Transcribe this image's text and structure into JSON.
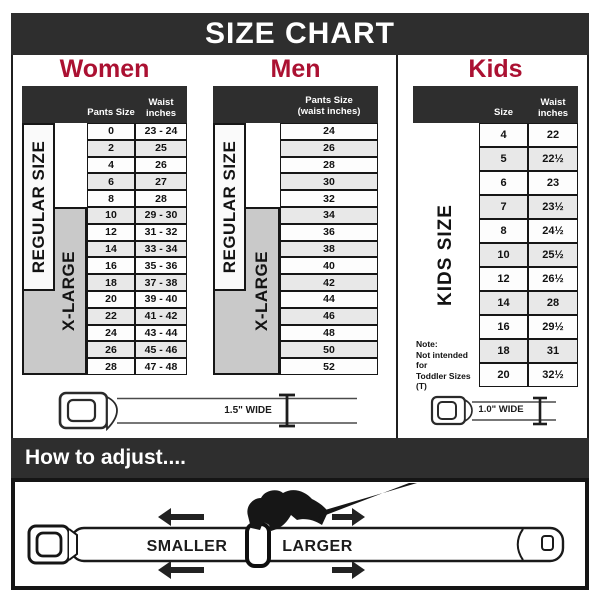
{
  "title": "SIZE CHART",
  "colors": {
    "header_bar": "#2e2e2e",
    "heading_red": "#ab1132",
    "row_stripe": "#e8e8e8",
    "label_gray": "#c9c9c9"
  },
  "sections": {
    "women": {
      "heading": "Women",
      "columns": {
        "size": "Pants Size",
        "waist_l1": "Waist",
        "waist_l2": "inches"
      },
      "labels": {
        "regular": "REGULAR SIZE",
        "xlarge": "X-LARGE"
      },
      "rows": [
        {
          "size": "0",
          "waist": "23 - 24"
        },
        {
          "size": "2",
          "waist": "25"
        },
        {
          "size": "4",
          "waist": "26"
        },
        {
          "size": "6",
          "waist": "27"
        },
        {
          "size": "8",
          "waist": "28"
        },
        {
          "size": "10",
          "waist": "29 - 30"
        },
        {
          "size": "12",
          "waist": "31 - 32"
        },
        {
          "size": "14",
          "waist": "33 - 34"
        },
        {
          "size": "16",
          "waist": "35 - 36"
        },
        {
          "size": "18",
          "waist": "37 - 38"
        },
        {
          "size": "20",
          "waist": "39 - 40"
        },
        {
          "size": "22",
          "waist": "41 - 42"
        },
        {
          "size": "24",
          "waist": "43 - 44"
        },
        {
          "size": "26",
          "waist": "45 - 46"
        },
        {
          "size": "28",
          "waist": "47 - 48"
        }
      ]
    },
    "men": {
      "heading": "Men",
      "columns": {
        "l1": "Pants Size",
        "l2": "(waist inches)"
      },
      "labels": {
        "regular": "REGULAR SIZE",
        "xlarge": "X-LARGE"
      },
      "rows": [
        "24",
        "26",
        "28",
        "30",
        "32",
        "34",
        "36",
        "38",
        "40",
        "42",
        "44",
        "46",
        "48",
        "50",
        "52"
      ]
    },
    "kids": {
      "heading": "Kids",
      "columns": {
        "size": "Size",
        "waist_l1": "Waist",
        "waist_l2": "inches"
      },
      "label": "KIDS SIZE",
      "note_lines": [
        "Note:",
        "Not intended for",
        "Toddler Sizes (T)"
      ],
      "rows": [
        {
          "size": "4",
          "waist": "22"
        },
        {
          "size": "5",
          "waist": "22½"
        },
        {
          "size": "6",
          "waist": "23"
        },
        {
          "size": "7",
          "waist": "23½"
        },
        {
          "size": "8",
          "waist": "24½"
        },
        {
          "size": "10",
          "waist": "25½"
        },
        {
          "size": "12",
          "waist": "26½"
        },
        {
          "size": "14",
          "waist": "28"
        },
        {
          "size": "16",
          "waist": "29½"
        },
        {
          "size": "18",
          "waist": "31"
        },
        {
          "size": "20",
          "waist": "32½"
        }
      ]
    }
  },
  "belts": {
    "adult_label": "1.5\" WIDE",
    "kids_label": "1.0\" WIDE"
  },
  "adjust": {
    "heading": "How to adjust....",
    "smaller": "SMALLER",
    "larger": "LARGER"
  }
}
